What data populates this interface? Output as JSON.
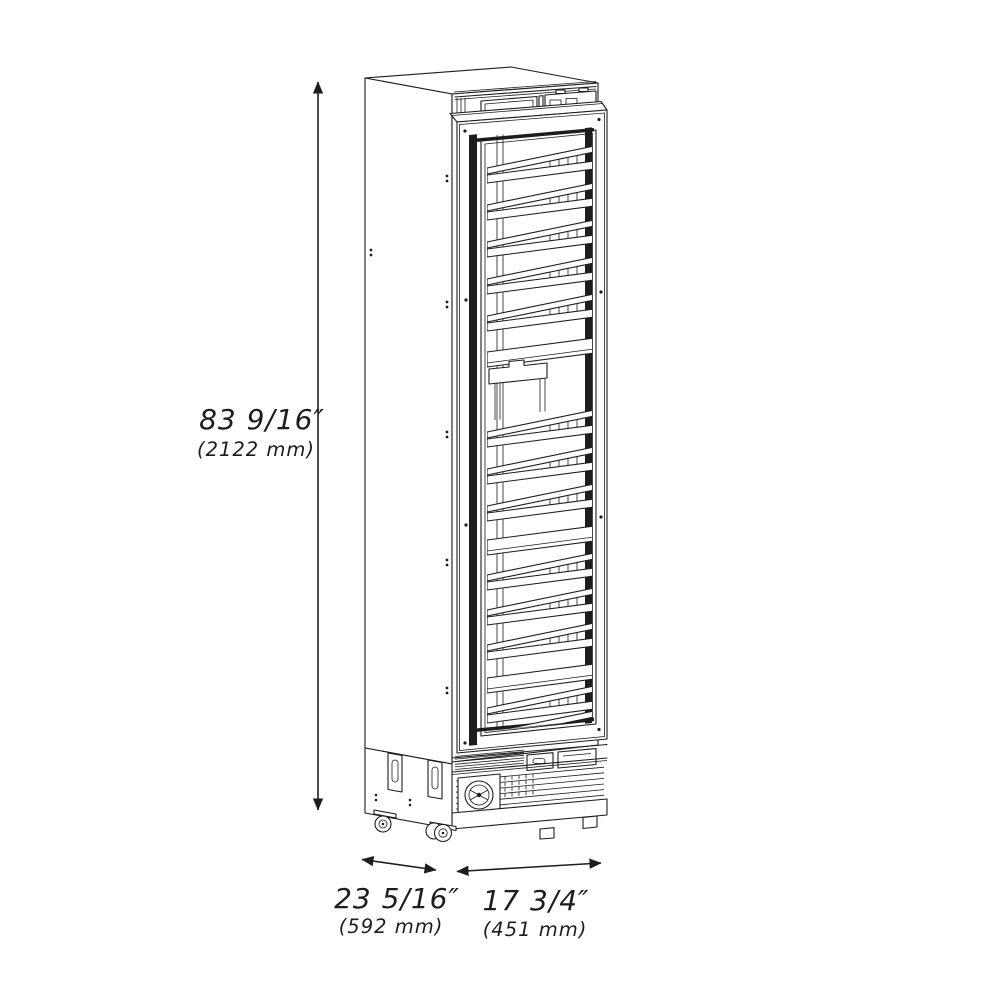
{
  "figure": {
    "subject": "tall single-door wine cooler with slide-out racks, isometric technical line drawing"
  },
  "dimensions": {
    "height": {
      "imperial": "83 9/16″",
      "metric": "(2122 mm)"
    },
    "depth": {
      "imperial": "23 5/16″",
      "metric": "(592 mm)"
    },
    "width": {
      "imperial": "17 3/4″",
      "metric": "(451 mm)"
    }
  },
  "colors": {
    "line": "#1d1d1b",
    "background": "#ffffff",
    "glass_edge": "#1d1d1b"
  }
}
